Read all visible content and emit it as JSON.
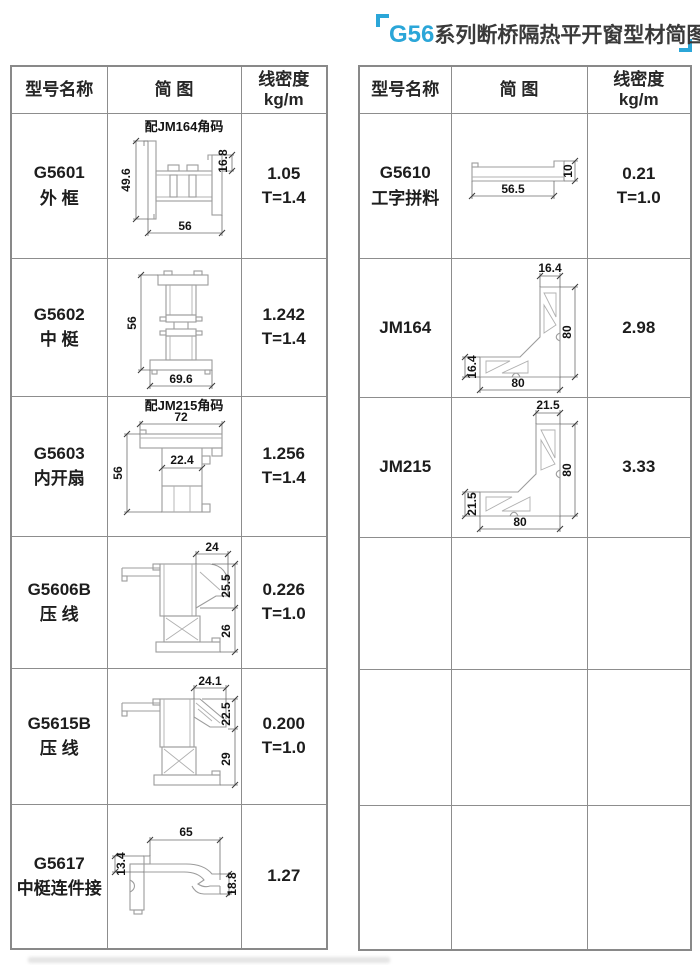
{
  "title": {
    "series": "G56",
    "rest": "系列断桥隔热平开窗型材简图"
  },
  "header": {
    "col_model": "型号名称",
    "col_diagram": "简 图",
    "col_density_1": "线密度",
    "col_density_2": "kg/m"
  },
  "left_table": {
    "rows": [
      {
        "model": "G5601",
        "name": "外 框",
        "density": "1.05",
        "thickness": "T=1.4",
        "note": "配JM164角码",
        "dims": {
          "left": "49.6",
          "right": "16.8",
          "bottom": "56"
        }
      },
      {
        "model": "G5602",
        "name": "中 梃",
        "density": "1.242",
        "thickness": "T=1.4",
        "dims": {
          "left": "56",
          "bottom": "69.6"
        }
      },
      {
        "model": "G5603",
        "name": "内开扇",
        "density": "1.256",
        "thickness": "T=1.4",
        "note": "配JM215角码",
        "dims": {
          "top": "72",
          "inner": "22.4",
          "left": "56"
        }
      },
      {
        "model": "G5606B",
        "name": "压 线",
        "density": "0.226",
        "thickness": "T=1.0",
        "dims": {
          "top": "24",
          "right_upper": "25.5",
          "right_lower": "26"
        }
      },
      {
        "model": "G5615B",
        "name": "压 线",
        "density": "0.200",
        "thickness": "T=1.0",
        "dims": {
          "top": "24.1",
          "right_upper": "22.5",
          "right_lower": "29"
        }
      },
      {
        "model": "G5617",
        "name": "中梃连件接",
        "density": "1.27",
        "thickness": "",
        "dims": {
          "left": "13.4",
          "top": "65",
          "right": "18.8"
        }
      }
    ]
  },
  "right_table": {
    "rows": [
      {
        "model": "G5610",
        "name": "工字拼料",
        "density": "0.21",
        "thickness": "T=1.0",
        "dims": {
          "bottom": "56.5",
          "right": "10"
        }
      },
      {
        "model": "JM164",
        "name": "",
        "density": "2.98",
        "thickness": "",
        "dims": {
          "top": "16.4",
          "right": "80",
          "left": "16.4",
          "bottom": "80"
        }
      },
      {
        "model": "JM215",
        "name": "",
        "density": "3.33",
        "thickness": "",
        "dims": {
          "top": "21.5",
          "right": "80",
          "left": "21.5",
          "bottom": "80"
        }
      }
    ]
  }
}
